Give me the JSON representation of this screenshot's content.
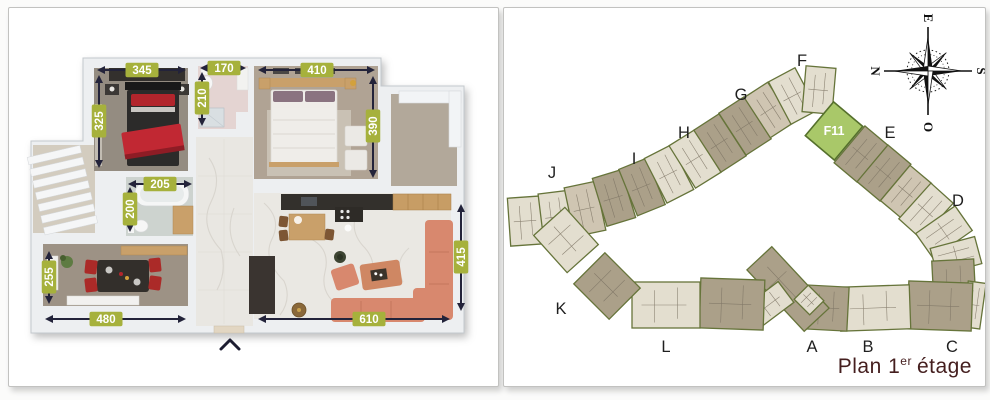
{
  "left_panel": {
    "dimensions": {
      "bedroom1_width": "345",
      "bath1_width": "170",
      "bedroom2_width": "410",
      "bedroom1_height": "325",
      "bath1_height": "210",
      "bedroom2_height": "390",
      "bath2_width": "205",
      "bath2_height": "200",
      "dining_height": "255",
      "dining_width": "480",
      "living_width": "610",
      "living_height": "415"
    }
  },
  "site_panel": {
    "highlighted_unit": "F11",
    "buildings": [
      {
        "label": "A"
      },
      {
        "label": "B"
      },
      {
        "label": "C"
      },
      {
        "label": "D"
      },
      {
        "label": "E"
      },
      {
        "label": "F"
      },
      {
        "label": "G"
      },
      {
        "label": "H"
      },
      {
        "label": "I"
      },
      {
        "label": "J"
      },
      {
        "label": "K"
      },
      {
        "label": "L"
      }
    ],
    "compass": {
      "north": "N",
      "east": "E",
      "south": "S",
      "west": "O"
    },
    "caption": {
      "prefix": "Plan 1",
      "superscript": "er",
      "suffix": "étage"
    }
  },
  "colors": {
    "dimension_badge": "#a6b13c",
    "arrow": "#23233a",
    "unit_highlight": "#a9c869",
    "unit_highlight_border": "#55702c",
    "building_outline": "#66743a",
    "building_fill_light": "#e3decf",
    "building_fill_mid": "#cfc5b2",
    "building_fill_dark": "#aba089",
    "caption_text": "#441e1e"
  }
}
